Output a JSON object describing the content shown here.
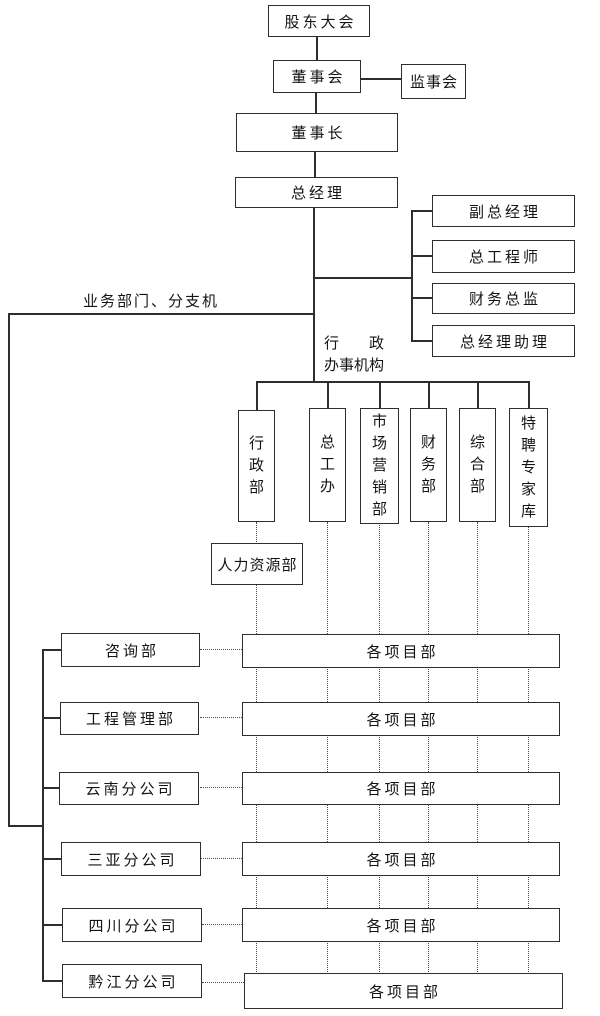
{
  "diagram": {
    "top": {
      "shareholders": "股东大会",
      "board": "董事会",
      "supervisory": "监事会",
      "chairman": "董事长",
      "general_manager": "总经理"
    },
    "staff": {
      "deputy_gm": "副总经理",
      "chief_engineer": "总工程师",
      "finance_director": "财务总监",
      "gm_assistant": "总经理助理"
    },
    "labels": {
      "business_branches": "业务部门、分支机",
      "admin_office_line1": "行　　政",
      "admin_office_line2": "办事机构"
    },
    "admin_departments": [
      "行政部",
      "总工办",
      "市场营销部",
      "财务部",
      "综合部",
      "特聘专家库"
    ],
    "hr_department": "人力资源部",
    "branch_units": [
      "咨询部",
      "工程管理部",
      "云南分公司",
      "三亚分公司",
      "四川分公司",
      "黔江分公司"
    ],
    "project_rows": [
      "各项目部",
      "各项目部",
      "各项目部",
      "各项目部",
      "各项目部",
      "各项目部"
    ],
    "line_color": "#2e2e2e"
  }
}
